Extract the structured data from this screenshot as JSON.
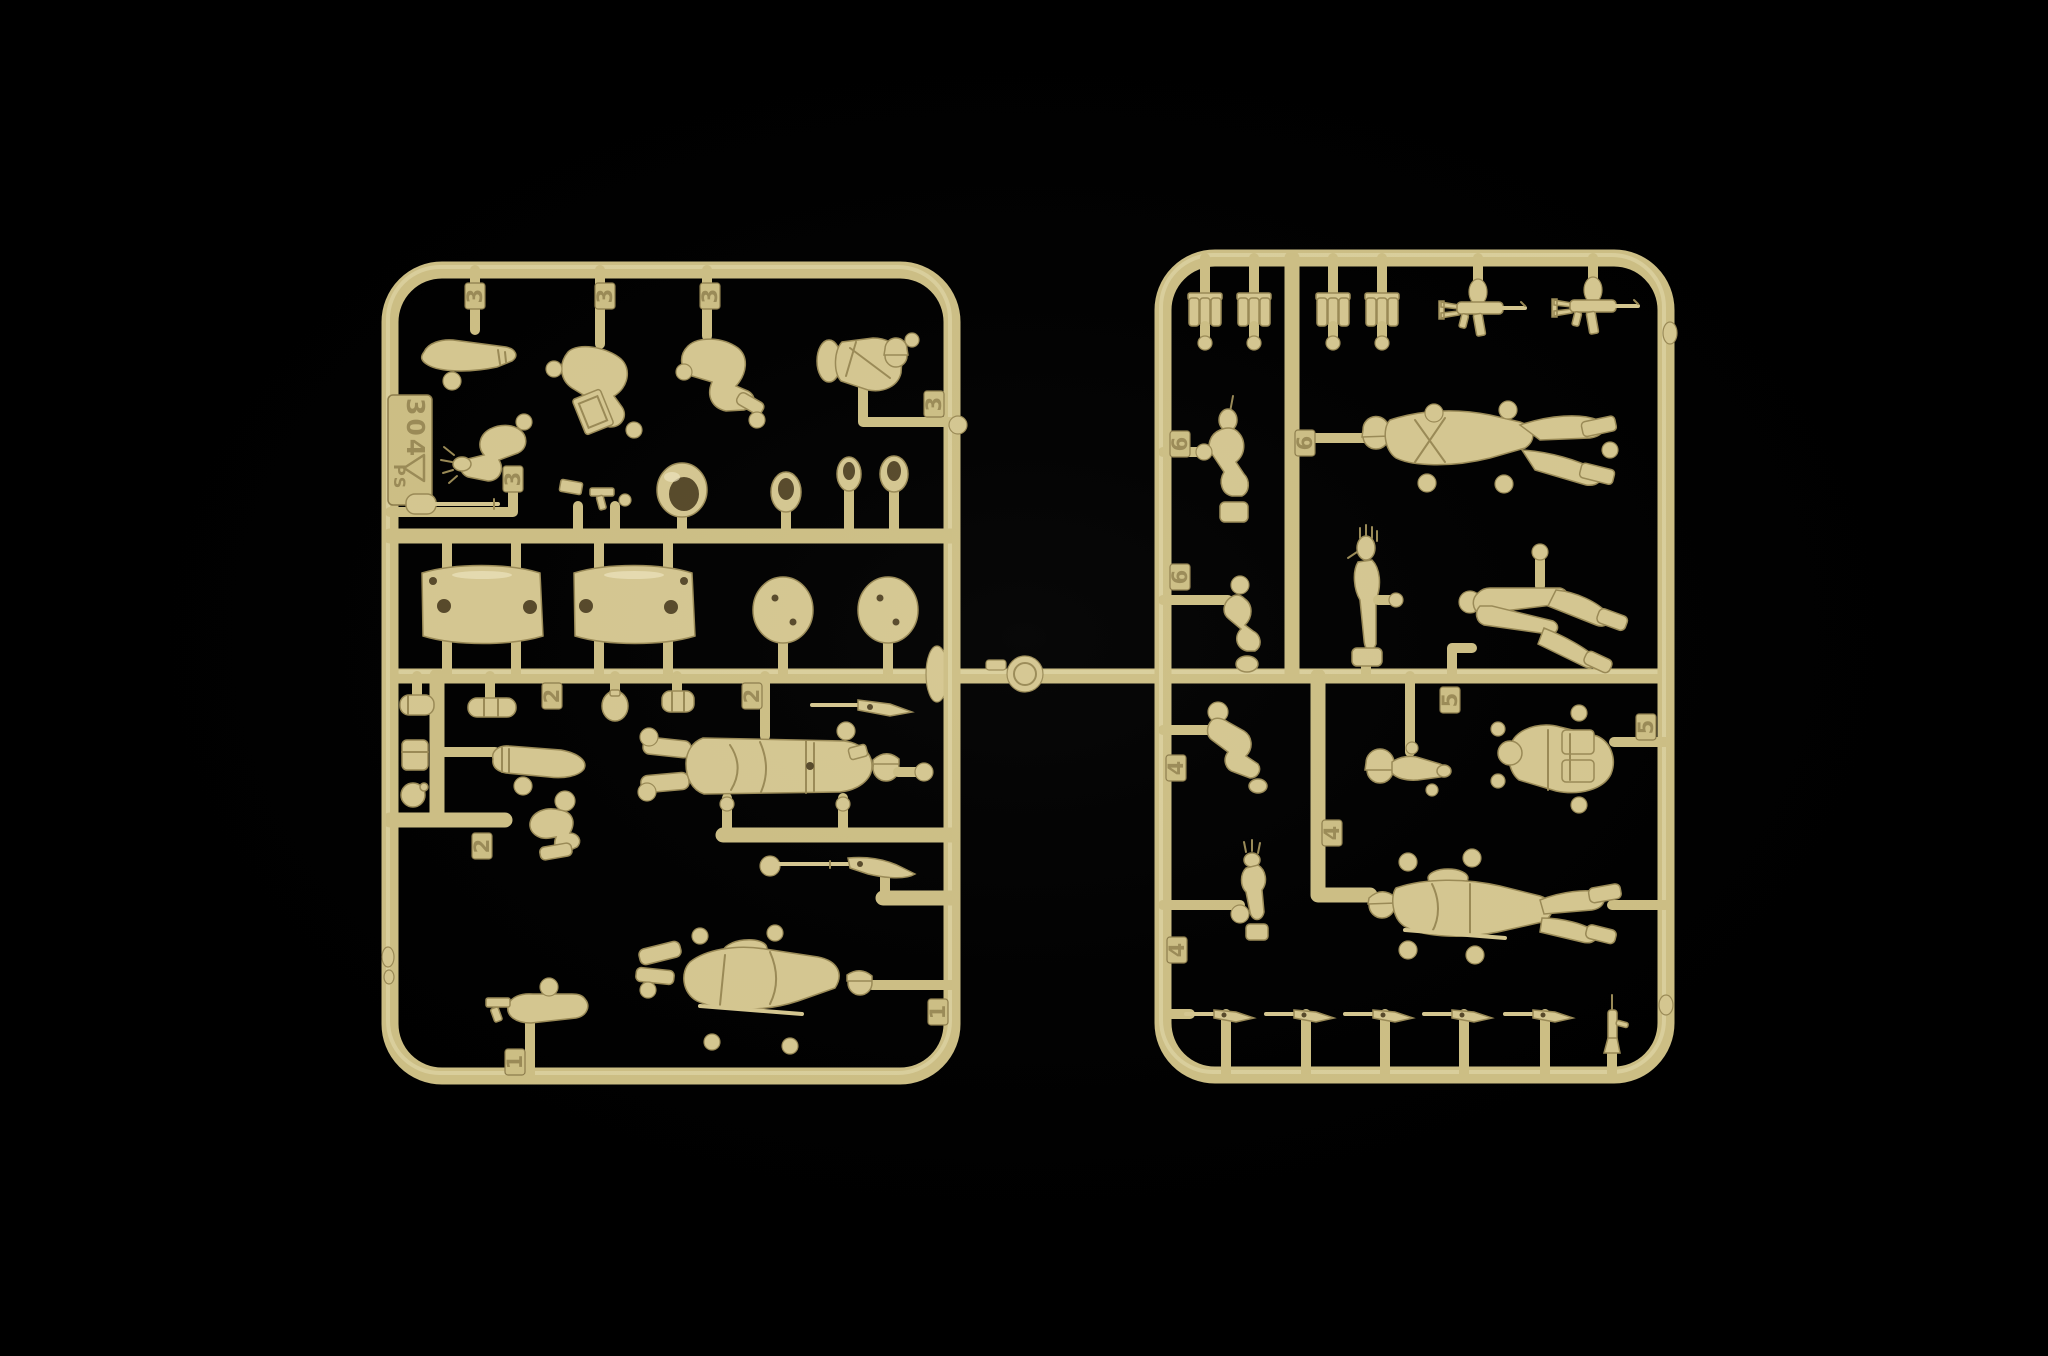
{
  "photo": {
    "subject": "two injection-molded tan plastic model-kit sprues with 1/72 scale soldier figure parts",
    "sprue_count": 2,
    "background": "black studio backdrop"
  },
  "palette": {
    "bg": "#000000",
    "sprue": "#cdbf85",
    "sprue-hi": "#ece3b8",
    "sprue-dark": "#8d7d4c",
    "part": "#d5c791",
    "part-hi": "#ece4bd",
    "part-dark": "#9a8a56",
    "recess": "#57492a",
    "emboss": "#9b8b57"
  },
  "left_sprue": {
    "label_plate": {
      "mold_number": "304",
      "material_code": "PS"
    },
    "part_number_tags": [
      "3",
      "3",
      "3",
      "3",
      "3",
      "2",
      "2",
      "2",
      "1",
      "1"
    ],
    "parts": [
      "straight-arm",
      "stooping-figure-with-case",
      "kneeling-legs",
      "gunner-torso-with-head",
      "raised-bent-arm-open-hand",
      "entrenching-tool",
      "pistol-with-bracket",
      "open-helmet-large",
      "helmet",
      "helmet",
      "helmet",
      "curved-panel",
      "curved-panel",
      "round-lid",
      "round-lid",
      "cylinder-pouch",
      "cylinder-pouch",
      "canteen",
      "canister",
      "carbine",
      "rolled-sleeve-arm",
      "belt-pouch",
      "round-canteen",
      "kneeling-leg",
      "officer-in-greatcoat",
      "rifle",
      "advancing-soldier-with-rifle",
      "arm-with-pistol"
    ]
  },
  "right_sprue": {
    "part_number_tags": [
      "6",
      "6",
      "6",
      "5",
      "5",
      "4",
      "4",
      "4"
    ],
    "parts": [
      "ammo-pouch-set",
      "ammo-pouch-set",
      "ammo-pouch-set",
      "ammo-pouch-set",
      "submachine-gun",
      "submachine-gun",
      "pointing-arm",
      "spread-legged-soldier",
      "bent-arm",
      "raised-arm-open-palm",
      "bent-legs",
      "lower-arm",
      "arm-open-hand",
      "head-with-arm",
      "torso-with-backpacks",
      "marching-soldier",
      "rifle",
      "rifle",
      "rifle",
      "rifle",
      "rifle",
      "upright-rifle"
    ]
  },
  "connector": {
    "feature": "runner bridge with round gate disc"
  }
}
